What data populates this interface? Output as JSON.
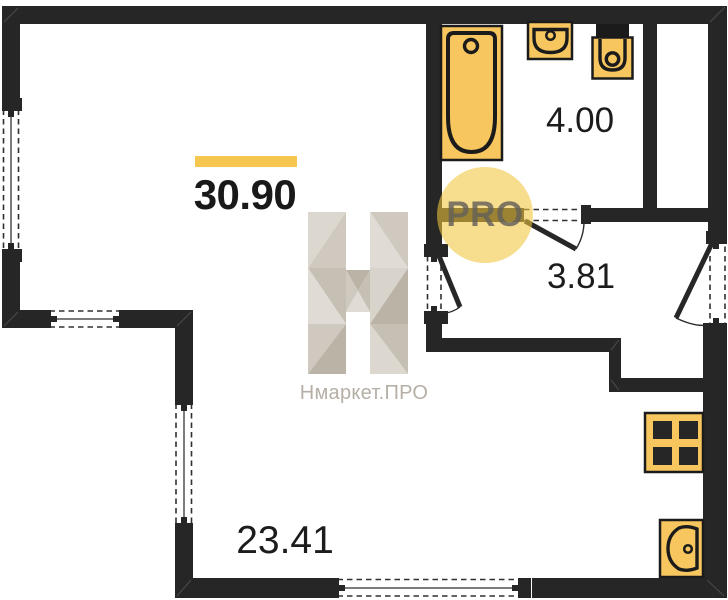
{
  "labels": {
    "total_area": "30.90",
    "bathroom_area": "4.00",
    "hallway_area": "3.81",
    "main_room_area": "23.41"
  },
  "watermark": {
    "brand": "Нмаркет.ПРО",
    "badge": "PRO"
  },
  "colors": {
    "wall": "#262626",
    "fixture_fill": "#f7c65e",
    "fixture_stroke": "#1b1b1b",
    "accent_bar": "#f6c74f",
    "badge_bg": "rgba(240,199,60,0.58)",
    "badge_text": "#9b958c",
    "watermark_text": "#b5afa5",
    "label_text": "#1c1c1c",
    "window_line": "#505050"
  },
  "fixtures": [
    "bathtub",
    "bathroom-sink",
    "toilet",
    "stove",
    "kitchen-sink"
  ]
}
